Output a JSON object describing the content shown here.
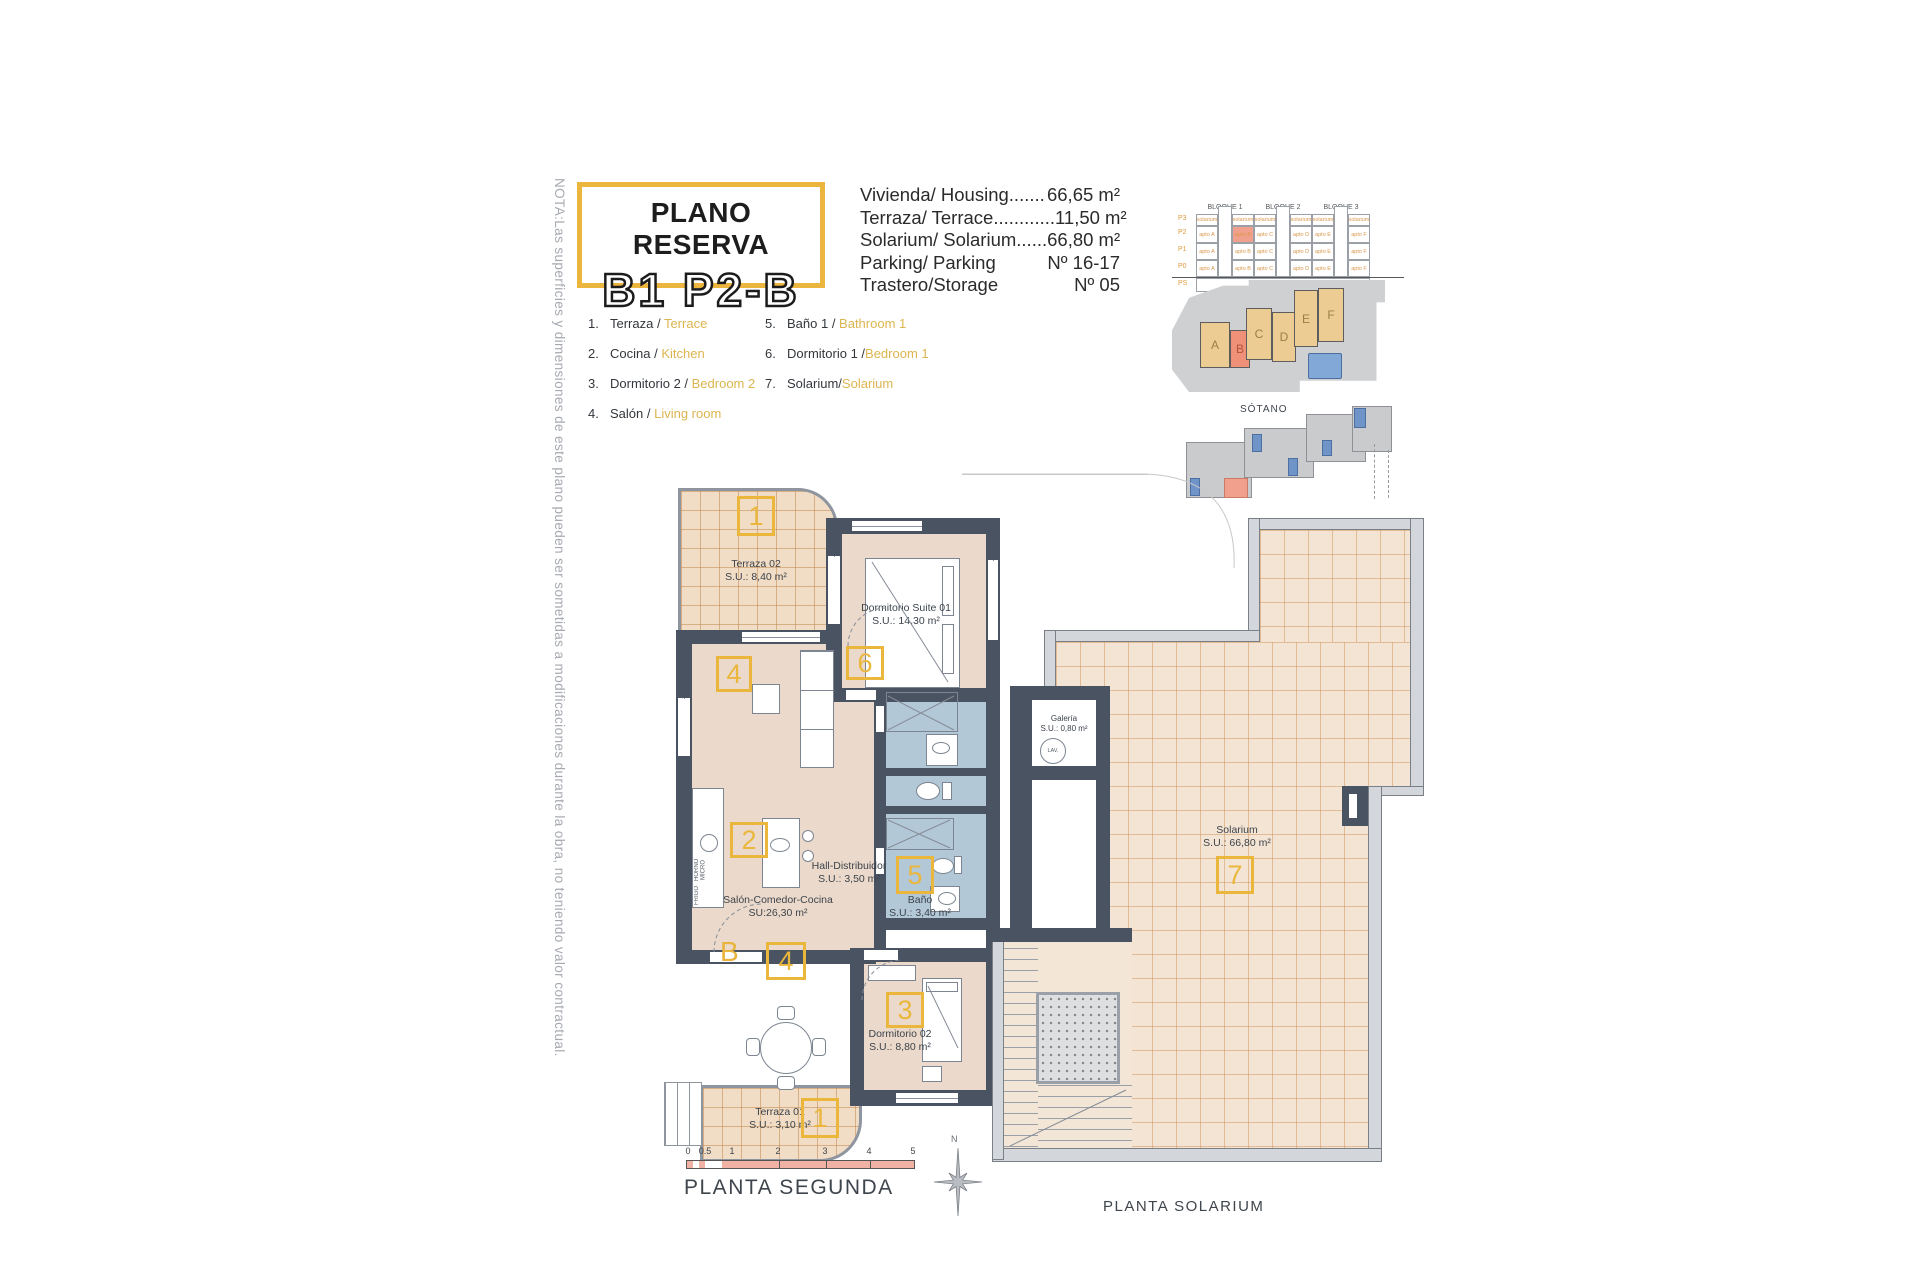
{
  "note_vertical": "NOTA:Las superficies y dimensiones de este plano pueden ser sometidas a modificaciones durante la obra, no teniendo valor contractual.",
  "title_block": {
    "line1": "PLANO RESERVA",
    "line2": "B1 P2-B"
  },
  "summary": {
    "rows": [
      {
        "label": "Vivienda/ Housing.......",
        "value": "66,65 m²"
      },
      {
        "label": "Terraza/ Terrace............",
        "value": "11,50 m²"
      },
      {
        "label": "Solarium/ Solarium......",
        "value": "66,80 m²"
      },
      {
        "label": "Parking/ Parking",
        "value": "Nº 16-17"
      },
      {
        "label": "Trastero/Storage",
        "value": "Nº 05"
      }
    ]
  },
  "legend": {
    "col1": [
      {
        "num": "1.",
        "es": "Terraza / ",
        "en": "Terrace"
      },
      {
        "num": "2.",
        "es": "Cocina / ",
        "en": "Kitchen"
      },
      {
        "num": "3.",
        "es": "Dormitorio 2 / ",
        "en": "Bedroom 2"
      },
      {
        "num": "4.",
        "es": "Salón / ",
        "en": "Living room"
      }
    ],
    "col2": [
      {
        "num": "5.",
        "es": "Baño 1 / ",
        "en": "Bathroom 1"
      },
      {
        "num": "6.",
        "es": "Dormitorio 1 /",
        "en": "Bedroom 1"
      },
      {
        "num": "7.",
        "es": "Solarium/",
        "en": "Solarium"
      }
    ]
  },
  "elevation": {
    "block_labels": [
      "BLOQUE 1",
      "BLOQUE 2",
      "BLOQUE 3"
    ],
    "row_labels": [
      "P3",
      "P2",
      "P1",
      "P0",
      "PS"
    ],
    "solarium_cell": "solarium",
    "apto_cells": [
      "apto A",
      "apto B",
      "apto C",
      "apto D",
      "apto E",
      "apto F"
    ],
    "basement": "SÓTANO"
  },
  "keyplan": {
    "buildings": [
      "A",
      "B",
      "C",
      "D",
      "E",
      "F"
    ]
  },
  "sotano": {
    "label": "SÓTANO"
  },
  "planta_segunda": {
    "title": "PLANTA SEGUNDA",
    "north": "N",
    "entry_letter": "B",
    "badges": {
      "terraza02": "1",
      "salon_top": "4",
      "cocina": "2",
      "salon_bottom": "4",
      "suite": "6",
      "bano": "5",
      "dorm02": "3",
      "terraza01": "1"
    },
    "rooms": {
      "terraza02": {
        "name": "Terraza 02",
        "area": "S.U.: 8,40 m²"
      },
      "suite": {
        "name": "Dormitorio Suite 01",
        "area": "S.U.: 14,30 m²"
      },
      "salon": {
        "name": "Salón-Comedor-Cocina",
        "area": "SU:26,30 m²"
      },
      "hall": {
        "name": "Hall-Distribuidor",
        "area": "S.U.: 3,50 m²"
      },
      "bano": {
        "name": "Baño",
        "area": "S.U.: 3,40 m²"
      },
      "dorm02": {
        "name": "Dormitorio 02",
        "area": "S.U.: 8,80 m²"
      },
      "terraza01": {
        "name": "Terraza 01",
        "area": "S.U.: 3,10 m²"
      }
    },
    "kitchen": {
      "horno": "HORNO MICRO",
      "frigo": "FRIGO"
    },
    "scale_ticks": [
      "0",
      "0.5",
      "1",
      "2",
      "3",
      "4",
      "5"
    ]
  },
  "planta_solarium": {
    "title": "PLANTA SOLARIUM",
    "rooms": {
      "solarium": {
        "name": "Solarium",
        "area": "S.U.: 66,80 m²",
        "badge": "7"
      },
      "galeria": {
        "name": "Galería",
        "area": "S.U.: 0,80 m²",
        "lav": "LAV."
      }
    }
  }
}
